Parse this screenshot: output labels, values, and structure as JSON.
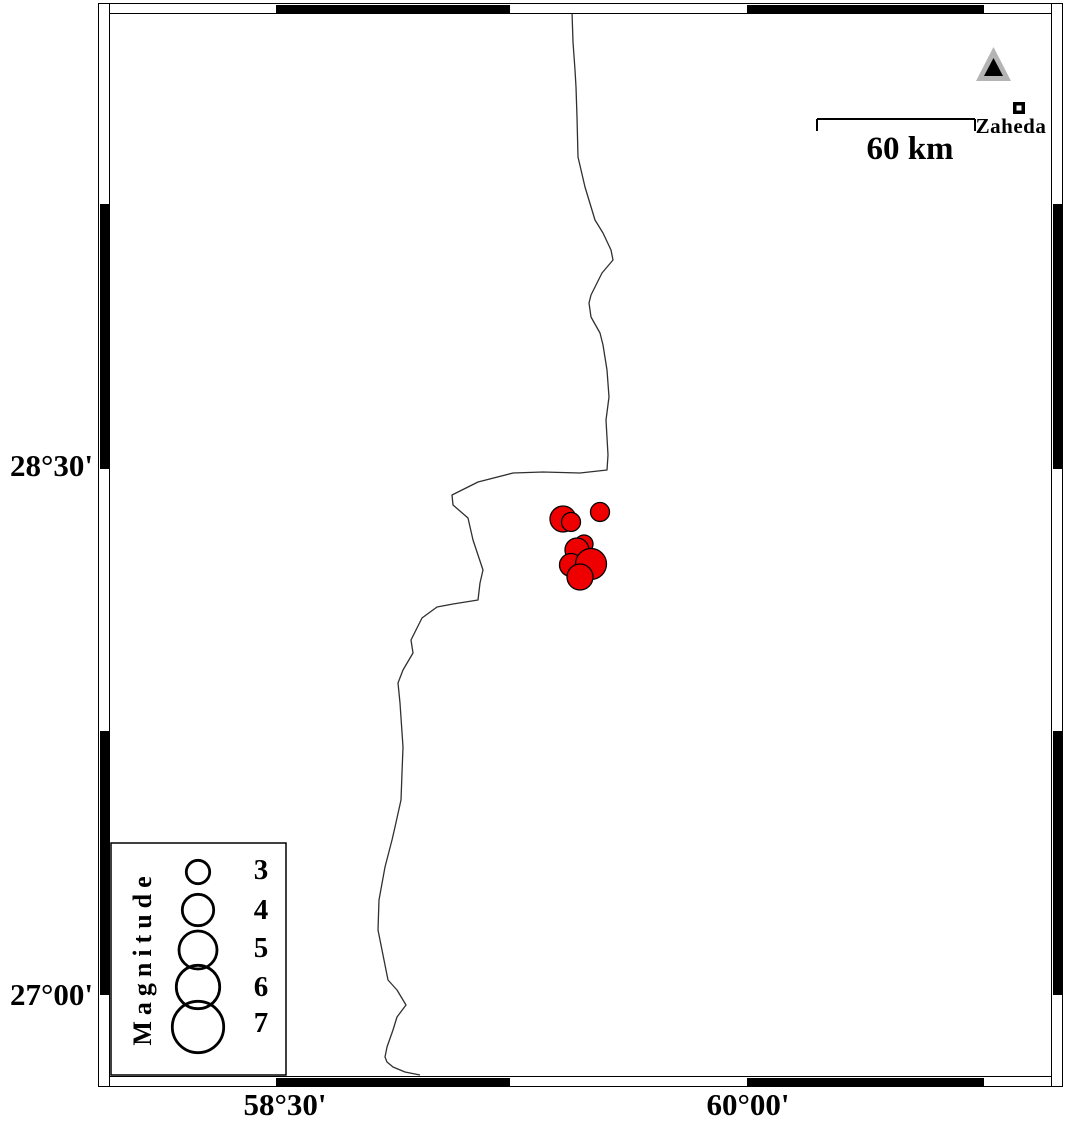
{
  "figure": {
    "frame": {
      "left_labels": [
        {
          "text": "28°30'"
        },
        {
          "text": "27°00'"
        }
      ],
      "bottom_labels": [
        {
          "text": "58°30'"
        },
        {
          "text": "60°00'"
        }
      ]
    },
    "scale_bar": {
      "label": "60 km",
      "x1": 817,
      "x2": 975,
      "y": 119,
      "tick_drop": 12
    },
    "station_marker": {
      "outer_points": "976,81 1011,81 993.5,47",
      "inner_points": "984,76 1003,76 993.5,58",
      "outer_color": "#b4b4b4",
      "inner_color": "#000000"
    },
    "city": {
      "name": "Zaheda",
      "x": 1013,
      "y": 102,
      "size": 12,
      "inner_size": 5
    },
    "legend": {
      "title": "Magnitude",
      "box": {
        "x": 111,
        "y": 843,
        "w": 175,
        "h": 232
      },
      "circle_cx": 198,
      "entries": [
        {
          "label": "3",
          "cy": 872,
          "r": 11.7
        },
        {
          "label": "4",
          "cy": 910,
          "r": 15.7
        },
        {
          "label": "5",
          "cy": 950,
          "r": 19.0
        },
        {
          "label": "6",
          "cy": 987,
          "r": 21.7
        },
        {
          "label": "7",
          "cy": 1027,
          "r": 25.7
        }
      ]
    },
    "epicenters": [
      {
        "x": 563,
        "y": 519,
        "r": 13.0
      },
      {
        "x": 600,
        "y": 512,
        "r": 9.5
      },
      {
        "x": 571,
        "y": 522,
        "r": 9.5
      },
      {
        "x": 584,
        "y": 544,
        "r": 9.0
      },
      {
        "x": 577,
        "y": 550,
        "r": 12.0
      },
      {
        "x": 571,
        "y": 565,
        "r": 11.5
      },
      {
        "x": 591,
        "y": 564,
        "r": 15.5
      },
      {
        "x": 580,
        "y": 577,
        "r": 13.0
      }
    ],
    "fault_line": {
      "points": [
        [
          572,
          12
        ],
        [
          573,
          42
        ],
        [
          575,
          70
        ],
        [
          576,
          87
        ],
        [
          577,
          117
        ],
        [
          578,
          157
        ],
        [
          585,
          187
        ],
        [
          595,
          220
        ],
        [
          603,
          233
        ],
        [
          611,
          250
        ],
        [
          613,
          260
        ],
        [
          602,
          273
        ],
        [
          591,
          295
        ],
        [
          589,
          303
        ],
        [
          591,
          317
        ],
        [
          600,
          333
        ],
        [
          603,
          345
        ],
        [
          607,
          370
        ],
        [
          609,
          397
        ],
        [
          606,
          420
        ],
        [
          608,
          455
        ],
        [
          607,
          470
        ],
        [
          580,
          473
        ],
        [
          543,
          472
        ],
        [
          513,
          473
        ],
        [
          478,
          482
        ],
        [
          452,
          495
        ],
        [
          453,
          505
        ],
        [
          468,
          518
        ],
        [
          473,
          540
        ],
        [
          483,
          570
        ],
        [
          480,
          583
        ],
        [
          478,
          600
        ],
        [
          453,
          604
        ],
        [
          437,
          607
        ],
        [
          422,
          618
        ],
        [
          411,
          640
        ],
        [
          413,
          653
        ],
        [
          403,
          670
        ],
        [
          398,
          683
        ],
        [
          400,
          703
        ],
        [
          403,
          747
        ],
        [
          402,
          773
        ],
        [
          401,
          800
        ],
        [
          395,
          827
        ],
        [
          392,
          840
        ],
        [
          385,
          867
        ],
        [
          379,
          900
        ],
        [
          378,
          930
        ],
        [
          382,
          950
        ],
        [
          388,
          980
        ],
        [
          397,
          990
        ],
        [
          406,
          1005
        ],
        [
          397,
          1017
        ],
        [
          393,
          1030
        ],
        [
          387,
          1047
        ],
        [
          385,
          1057
        ],
        [
          387,
          1062
        ],
        [
          393,
          1067
        ],
        [
          405,
          1072
        ],
        [
          420,
          1075
        ]
      ]
    },
    "colors": {
      "epicenter": "#ee0000",
      "line": "#303030",
      "black": "#000000"
    }
  }
}
